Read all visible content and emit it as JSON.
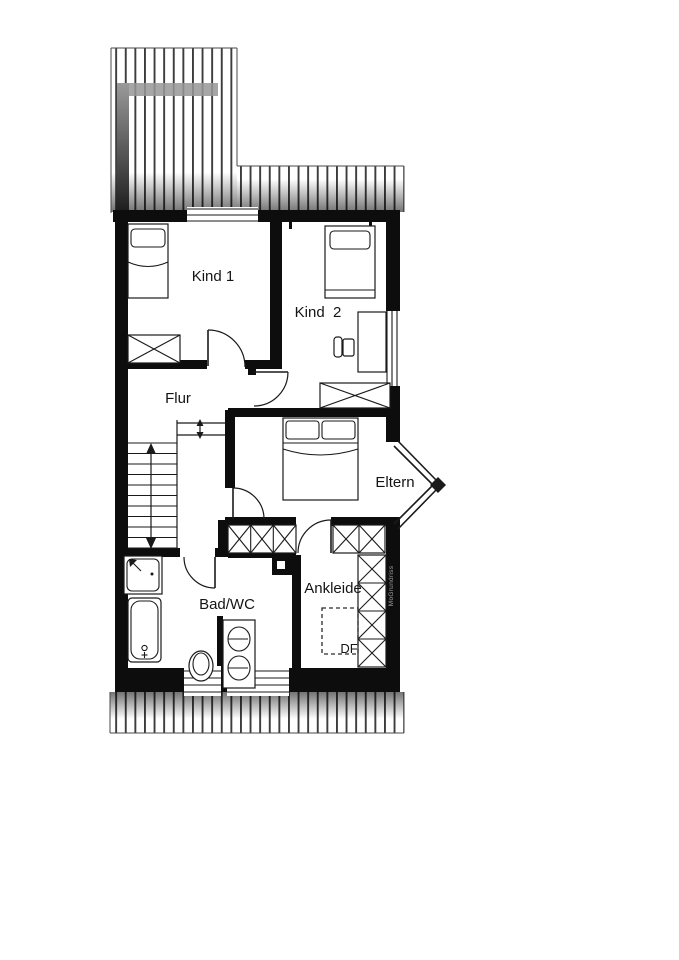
{
  "rooms": {
    "kind1": {
      "label": "Kind 1"
    },
    "kind2": {
      "label": "Kind  2"
    },
    "flur": {
      "label": "Flur"
    },
    "eltern": {
      "label": "Eltern"
    },
    "bad_wc": {
      "label": "Bad/WC"
    },
    "ankleide": {
      "label": "Ankleide"
    }
  },
  "annotations": {
    "roof_window_label": "DF",
    "watermark": "MoGrundriss"
  },
  "fixtures": {
    "kind1": [
      "single-bed",
      "wardrobe"
    ],
    "kind2": [
      "single-bed",
      "desk",
      "chair",
      "wardrobe"
    ],
    "eltern": [
      "double-bed",
      "bay-window"
    ],
    "flur": [
      "staircase",
      "landing"
    ],
    "bad_wc": [
      "shower",
      "bathtub",
      "toilet",
      "double-washbasin"
    ],
    "ankleide": [
      "wardrobe-row",
      "wardrobe-column",
      "roof-window",
      "chimney"
    ]
  },
  "colors": {
    "background": "#ffffff",
    "wall": "#0d0d0d",
    "line": "#1a1a1a",
    "roof_stripe": "#3c3c3c",
    "gray_band": "#969696",
    "label": "#141414",
    "watermark": "#a0a0a0"
  }
}
